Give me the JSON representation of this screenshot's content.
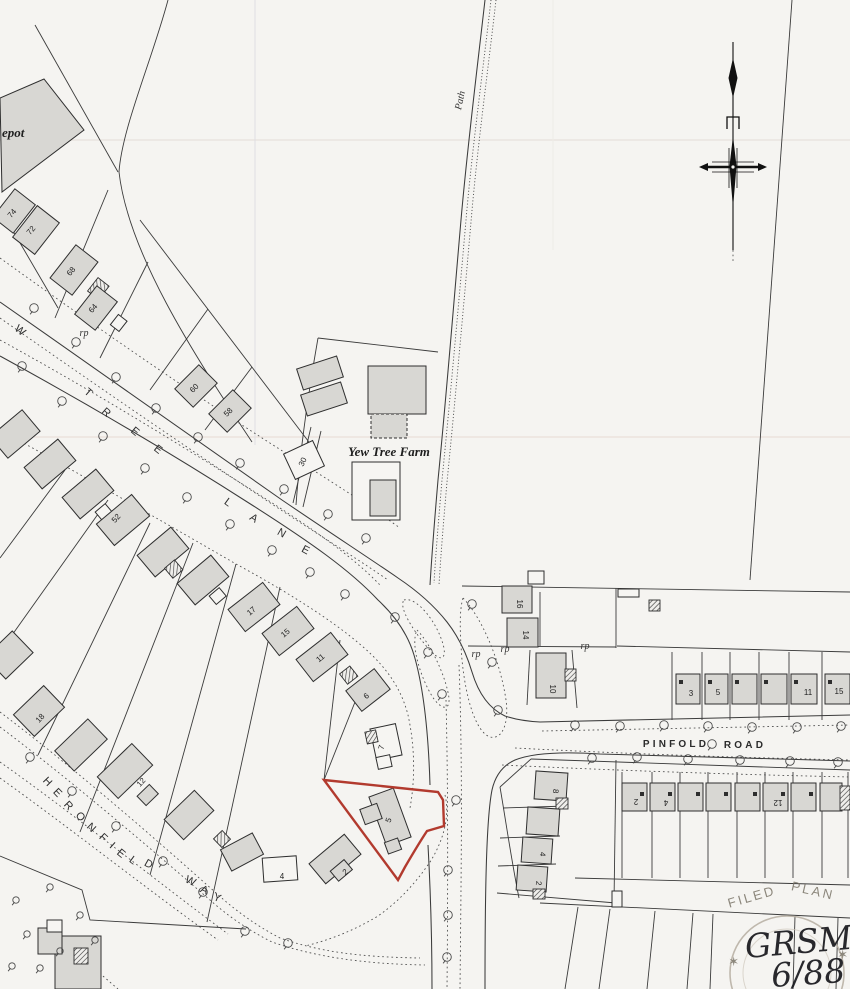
{
  "map": {
    "road_names": [
      "YEW TREE LANE",
      "PINFOLD ROAD",
      "HERONFIELD WAY"
    ],
    "place_names": [
      "Yew Tree Farm",
      "Path",
      "epot"
    ],
    "abbreviations": [
      "rp"
    ],
    "stamp": {
      "arc_text": "FILED PLAN",
      "handwritten_reference": "GRSM.",
      "handwritten_date": "6/88"
    },
    "colors": {
      "paper": "#f5f4f1",
      "ink": "#3b3b3b",
      "building_fill": "#d8d7d3",
      "red_outline": "#b23a2e",
      "stamp_ink": "#8d8578"
    },
    "labels": [
      [
        "W",
        18,
        333,
        40,
        11,
        "rl"
      ],
      [
        "T",
        86,
        395,
        41,
        11,
        "rl"
      ],
      [
        "R",
        104,
        415,
        41,
        11,
        "rl"
      ],
      [
        "E",
        133,
        434,
        40,
        11,
        "rl"
      ],
      [
        "E",
        156,
        452,
        38,
        11,
        "rl"
      ],
      [
        "L",
        226,
        505,
        36,
        11,
        "rl"
      ],
      [
        "A",
        252,
        521,
        33,
        11,
        "rl"
      ],
      [
        "N",
        280,
        536,
        30,
        11,
        "rl"
      ],
      [
        "E",
        304,
        553,
        28,
        11,
        "rl"
      ],
      [
        "H",
        45,
        784,
        46,
        10,
        "rl"
      ],
      [
        "E",
        55,
        795,
        46,
        10,
        "rl"
      ],
      [
        "R",
        66,
        808,
        46,
        10,
        "rl"
      ],
      [
        "O",
        78,
        819,
        45,
        10,
        "rl"
      ],
      [
        "N",
        89,
        830,
        44,
        10,
        "rl"
      ],
      [
        "F",
        101,
        840,
        43,
        10,
        "rl"
      ],
      [
        "I",
        110,
        848,
        42,
        10,
        "rl"
      ],
      [
        "E",
        119,
        856,
        40,
        10,
        "rl"
      ],
      [
        "L",
        131,
        863,
        36,
        10,
        "rl"
      ],
      [
        "D",
        147,
        867,
        30,
        10,
        "rl"
      ],
      [
        "W",
        189,
        884,
        26,
        10,
        "rl"
      ],
      [
        "A",
        203,
        893,
        23,
        10,
        "rl"
      ],
      [
        "Y",
        216,
        901,
        21,
        10,
        "rl"
      ],
      [
        "PINFOLD",
        676,
        747,
        0,
        10,
        "rw"
      ],
      [
        "ROAD",
        745,
        748,
        0,
        10,
        "rw"
      ],
      [
        "Yew Tree Farm",
        389,
        456,
        0,
        13,
        "sbi"
      ],
      [
        "epot",
        2,
        137,
        0,
        13,
        "sbi",
        "start"
      ],
      [
        "Path",
        463,
        101,
        -78,
        11,
        "si"
      ],
      [
        "rp",
        84,
        336,
        0,
        9,
        "si"
      ],
      [
        "rp",
        476,
        657,
        0,
        9,
        "si"
      ],
      [
        "rp",
        505,
        652,
        0,
        9,
        "si"
      ],
      [
        "rp",
        585,
        649,
        0,
        9,
        "si"
      ],
      [
        "74",
        14,
        215,
        -50,
        8,
        "nm"
      ],
      [
        "72",
        33,
        232,
        -50,
        8,
        "nm"
      ],
      [
        "68",
        73,
        273,
        -50,
        8,
        "nm"
      ],
      [
        "64",
        95,
        310,
        -50,
        8,
        "nm"
      ],
      [
        "60",
        196,
        390,
        -45,
        8,
        "nm"
      ],
      [
        "58",
        230,
        414,
        -45,
        8,
        "nm"
      ],
      [
        "30",
        305,
        463,
        -65,
        8,
        "nm"
      ],
      [
        "52",
        118,
        520,
        -48,
        8,
        "nm"
      ],
      [
        "17",
        253,
        613,
        -40,
        8,
        "nm"
      ],
      [
        "15",
        287,
        635,
        -40,
        8,
        "nm"
      ],
      [
        "11",
        322,
        660,
        -40,
        8,
        "nm"
      ],
      [
        "6",
        368,
        698,
        -40,
        8,
        "nm"
      ],
      [
        "7",
        384,
        748,
        -75,
        8,
        "nm"
      ],
      [
        "5",
        391,
        821,
        -70,
        8,
        "nm"
      ],
      [
        "2",
        347,
        874,
        -40,
        8,
        "nm"
      ],
      [
        "4",
        282,
        879,
        0,
        8,
        "nm"
      ],
      [
        "18",
        42,
        720,
        -48,
        8,
        "nm"
      ],
      [
        "12",
        143,
        784,
        -48,
        8,
        "nm"
      ],
      [
        "16",
        517,
        604,
        90,
        8,
        "nm"
      ],
      [
        "14",
        523,
        635,
        90,
        8,
        "nm"
      ],
      [
        "10",
        550,
        689,
        90,
        8,
        "nm"
      ],
      [
        "3",
        691,
        696,
        0,
        8,
        "nm"
      ],
      [
        "5",
        718,
        695,
        0,
        8,
        "nm"
      ],
      [
        "11",
        808,
        695,
        0,
        8,
        "nm"
      ],
      [
        "15",
        839,
        694,
        0,
        8,
        "nm"
      ],
      [
        "2",
        636,
        799,
        180,
        8,
        "nm"
      ],
      [
        "4",
        666,
        800,
        180,
        8,
        "nm"
      ],
      [
        "12",
        778,
        800,
        180,
        8,
        "nm"
      ],
      [
        "8",
        553,
        791,
        95,
        8,
        "nm"
      ],
      [
        "4",
        540,
        854,
        95,
        8,
        "nm"
      ],
      [
        "2",
        536,
        883,
        95,
        8,
        "nm"
      ],
      [
        "FILED",
        753,
        901,
        -16,
        13,
        "st"
      ],
      [
        "PLAN",
        812,
        895,
        13,
        13,
        "st"
      ],
      [
        "✶",
        735,
        966,
        0,
        11,
        "st"
      ],
      [
        "✶",
        844,
        959,
        0,
        11,
        "st"
      ],
      [
        "GRSM.",
        746,
        958,
        -5,
        33,
        "hw",
        "start"
      ],
      [
        "6/88",
        772,
        987,
        -4,
        29,
        "hw",
        "start"
      ]
    ],
    "trees": [
      [
        34,
        308
      ],
      [
        76,
        342
      ],
      [
        116,
        377
      ],
      [
        156,
        408
      ],
      [
        198,
        437
      ],
      [
        240,
        463
      ],
      [
        284,
        489
      ],
      [
        328,
        514
      ],
      [
        366,
        538
      ],
      [
        22,
        366
      ],
      [
        62,
        401
      ],
      [
        103,
        436
      ],
      [
        145,
        468
      ],
      [
        187,
        497
      ],
      [
        230,
        524
      ],
      [
        272,
        550
      ],
      [
        310,
        572
      ],
      [
        345,
        594
      ],
      [
        395,
        617
      ],
      [
        428,
        652
      ],
      [
        442,
        694
      ],
      [
        472,
        604
      ],
      [
        492,
        662
      ],
      [
        498,
        710
      ],
      [
        456,
        800
      ],
      [
        575,
        725
      ],
      [
        620,
        726
      ],
      [
        664,
        725
      ],
      [
        708,
        726
      ],
      [
        752,
        727
      ],
      [
        797,
        727
      ],
      [
        841,
        726
      ],
      [
        712,
        744
      ],
      [
        592,
        758
      ],
      [
        637,
        757
      ],
      [
        688,
        759
      ],
      [
        740,
        760
      ],
      [
        790,
        761
      ],
      [
        838,
        762
      ],
      [
        448,
        870
      ],
      [
        448,
        915
      ],
      [
        447,
        957
      ],
      [
        30,
        757
      ],
      [
        72,
        791
      ],
      [
        116,
        826
      ],
      [
        163,
        861
      ],
      [
        203,
        892
      ],
      [
        245,
        931
      ],
      [
        288,
        943
      ],
      [
        16,
        900,
        1
      ],
      [
        50,
        887,
        1
      ],
      [
        80,
        915,
        1
      ],
      [
        27,
        934,
        1
      ],
      [
        60,
        951,
        1
      ],
      [
        12,
        966,
        1
      ],
      [
        95,
        940,
        1
      ],
      [
        40,
        968,
        1
      ]
    ]
  }
}
